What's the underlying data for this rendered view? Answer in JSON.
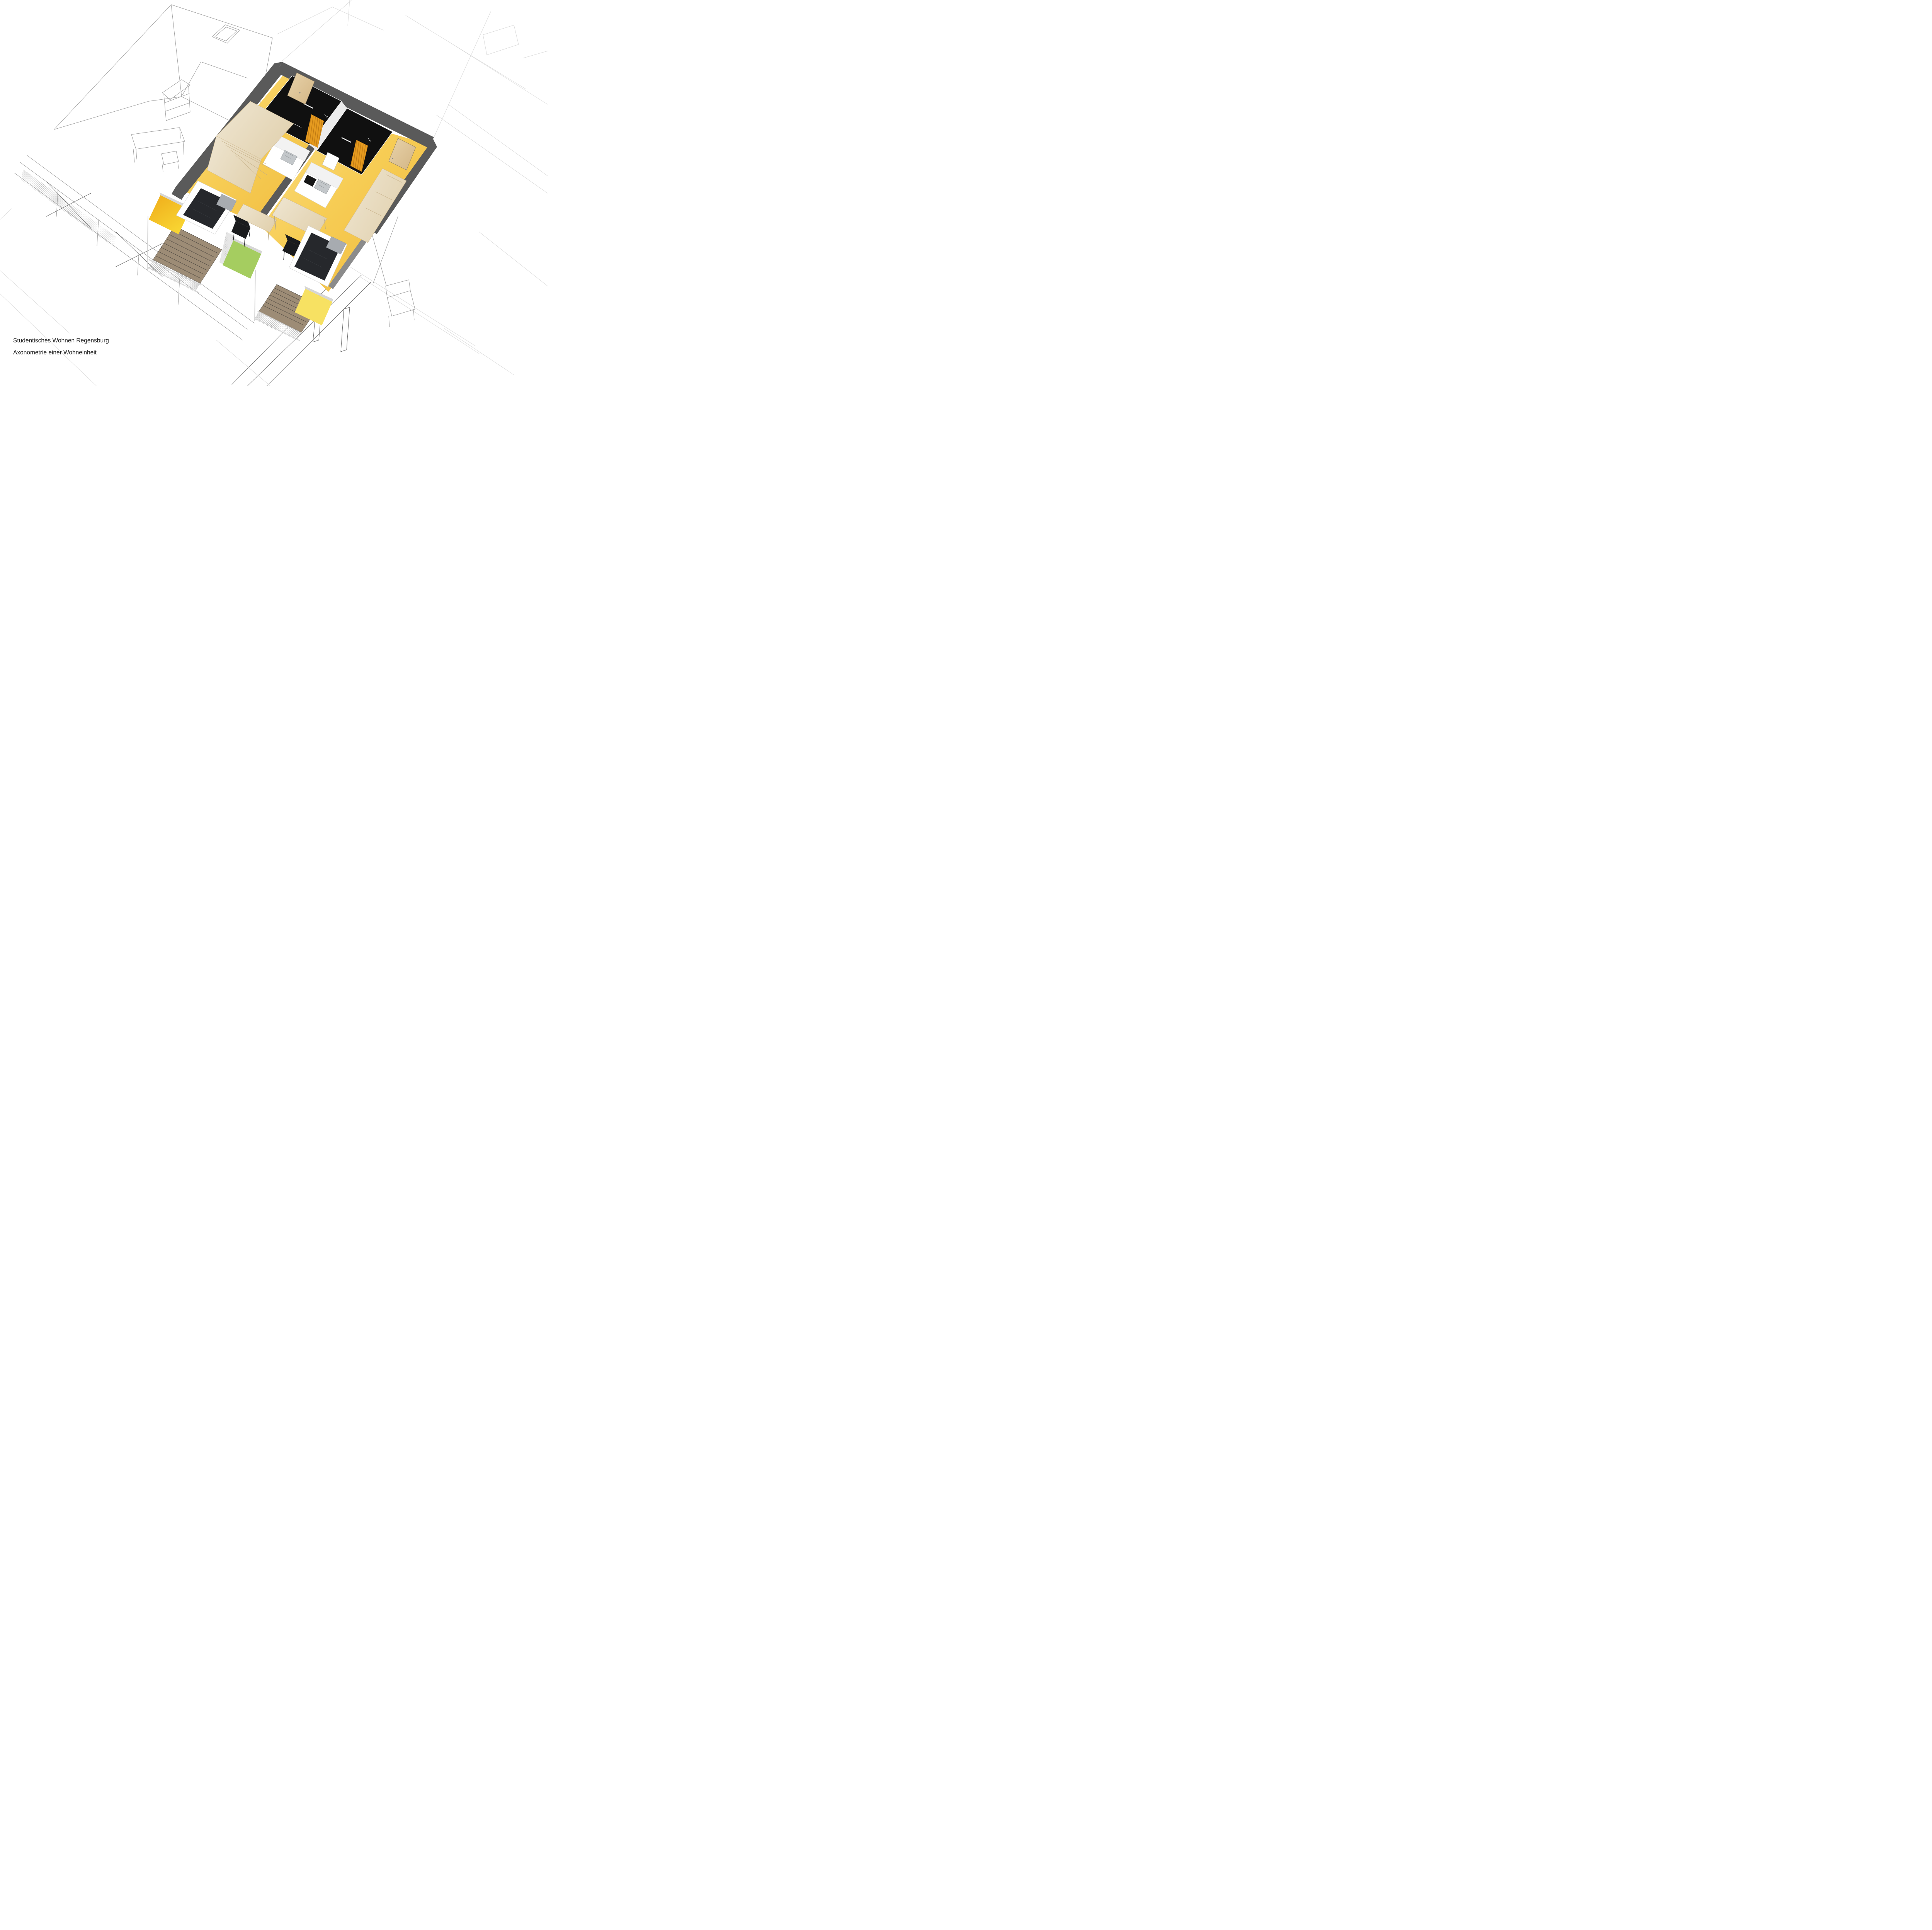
{
  "document": {
    "caption_line1": "Studentisches Wohnen Regensburg",
    "caption_line2": "Axonometrie einer Wohneinheit"
  },
  "colors": {
    "background": "#ffffff",
    "text": "#1a1a1a",
    "wireframe_line": "#9a9a9a",
    "wireframe_faint": "#d9d9d9",
    "wireframe_dark": "#5f5f5f",
    "wall_cut": "#5a5a5a",
    "wall_section_light": "#8b8b8b",
    "wall_inner": "#ececec",
    "hall_floor": "#dcdcdc",
    "floor_light": "#fadf85",
    "floor_mid": "#f7cd55",
    "floor_deep": "#efb93c",
    "pod_black": "#101010",
    "curtain_orange": "#e59a1f",
    "curtain_shadow": "#bd7812",
    "wood_light": "#efe6d2",
    "wood_mid": "#e2d2b0",
    "wood_dark": "#cdb78d",
    "door_light": "#e8d3ab",
    "door_dark": "#d3b584",
    "deck_wood": "#9d8c76",
    "deck_line": "#45403a",
    "panel_amber_light": "#f9d733",
    "panel_amber_deep": "#efab1a",
    "panel_green": "#a5cd60",
    "panel_yellow": "#f7e162",
    "frame_grey": "#d6d6d6",
    "steel": "#c3c7ca",
    "sink_line": "#8f9497",
    "bed_duvet": "#26282c",
    "bed_pillow": "#a7abb0",
    "bed_frame": "#ffffff",
    "chair_black": "#1a1b1d"
  }
}
